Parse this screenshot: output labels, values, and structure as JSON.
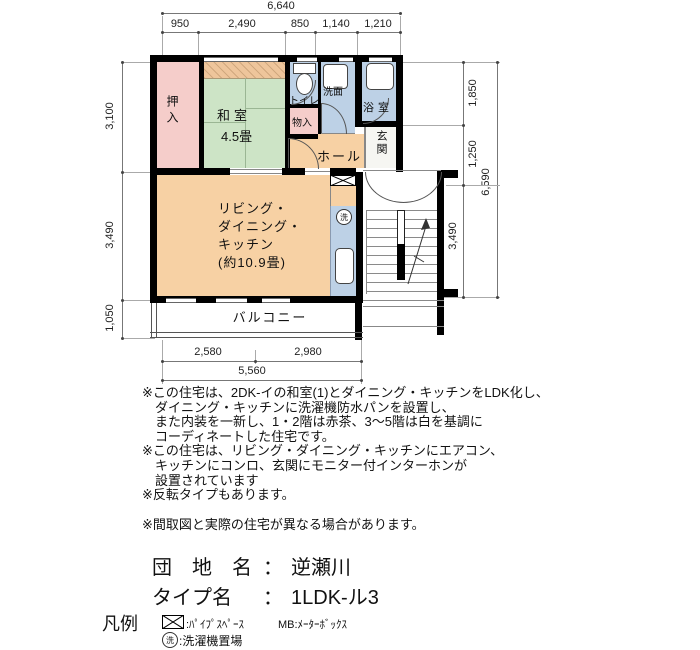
{
  "plan": {
    "dimensions": {
      "top_total": "6,640",
      "top_segments": [
        "950",
        "2,490",
        "850",
        "1,140",
        "1,210"
      ],
      "left_segments": [
        "3,100",
        "3,490",
        "1,050"
      ],
      "right_segments": [
        "1,850",
        "1,250",
        "3,490"
      ],
      "right_total": "6,590",
      "bottom_segments": [
        "2,580",
        "2,980"
      ],
      "bottom_total": "5,560"
    },
    "rooms": {
      "oshiire": "押入",
      "washitsu": "和室",
      "washitsu_size": "4.5畳",
      "toilet": "トイレ",
      "monoire": "物入",
      "senmen": "洗面",
      "bathroom": "浴室",
      "hall": "ホール",
      "genkan": "玄関",
      "ldk": [
        "リビング・",
        "ダイニング・",
        "キッチン",
        "(約10.9畳)"
      ],
      "balcony": "バルコニー",
      "laundry_symbol": "洗"
    },
    "colors": {
      "wall": "#000000",
      "tatami_green": "#cde4c6",
      "closet_pink": "#f5cdca",
      "wet_area_blue": "#bdd1e6",
      "ldk_orange": "#f7d1a4",
      "genkan_white": "#f6f6f2"
    }
  },
  "notes": [
    "※この住宅は、2DK-イの和室(1)とダイニング・キッチンをLDK化し、",
    "ダイニング・キッチンに洗濯機防水パンを設置し、",
    "また内装を一新し、1・2階は赤茶、3～5階は白を基調に",
    "コーディネートした住宅です。",
    "※この住宅は、リビング・ダイニング・キッチンにエアコン、",
    "キッチンにコンロ、玄関にモニター付インターホンが",
    "設置されています",
    "※反転タイプもあります。",
    "※間取図と実際の住宅が異なる場合があります。"
  ],
  "info": {
    "danchi_label": "団　地　名",
    "colon": "：",
    "danchi_value": "逆瀬川",
    "type_label": "タイプ名",
    "type_value": "1LDK-ル3"
  },
  "legend": {
    "title": "凡例",
    "pipe_space_label": ":ﾊﾟｲﾌﾟｽﾍﾟｰｽ",
    "mb_label": "MB:ﾒｰﾀｰﾎﾞｯｸｽ",
    "laundry_symbol": "洗",
    "laundry_label": ":洗濯機置場"
  }
}
